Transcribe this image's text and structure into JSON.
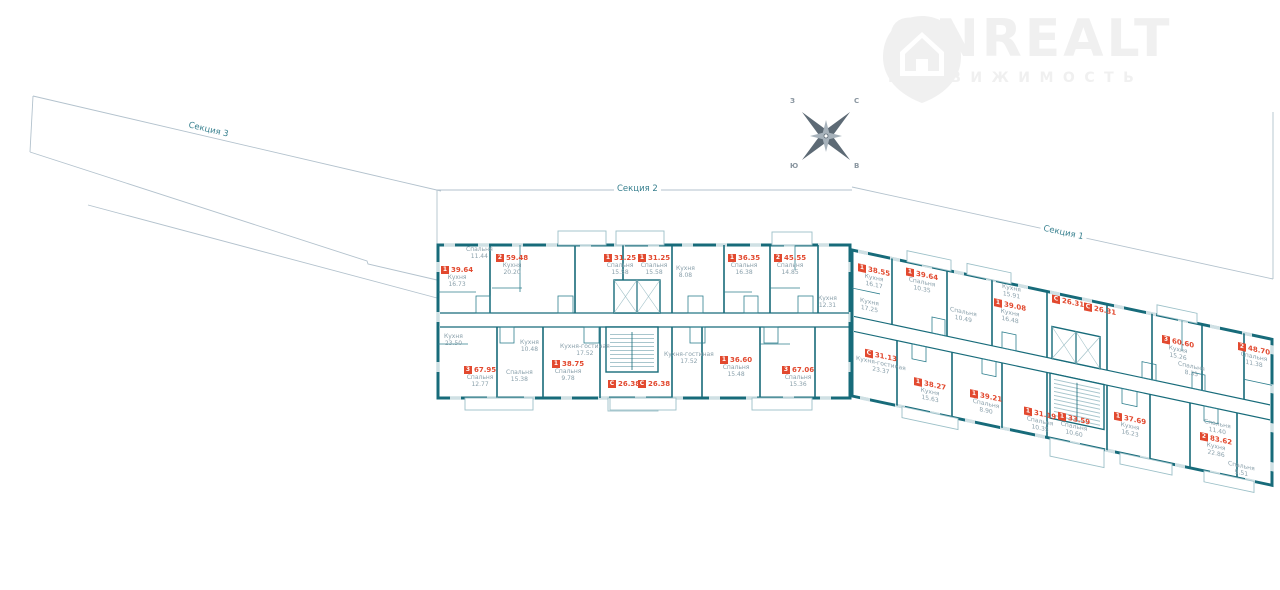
{
  "watermark": {
    "brand": "ONREALT",
    "subtitle": "НЕДВИЖИМОСТЬ"
  },
  "compass": {
    "north": "С",
    "east": "В",
    "south": "Ю",
    "west": "З"
  },
  "sections": {
    "s3": {
      "label": "Секция 3"
    },
    "s2": {
      "label": "Секция 2",
      "units": [
        {
          "rooms": "1",
          "area": "39.64",
          "room": "Кухня",
          "room_area": "16.73"
        },
        {
          "rooms": "2",
          "area": "59.48",
          "room": "Кухня",
          "room_area": "20.20"
        },
        {
          "rooms": "1",
          "area": "31.25",
          "room": "Спальня",
          "room_area": "15.58"
        },
        {
          "rooms": "1",
          "area": "31.25",
          "room": "Спальня",
          "room_area": "15.58"
        },
        {
          "rooms": "1",
          "area": "36.35",
          "room": "Спальня",
          "room_area": "16.38"
        },
        {
          "rooms": "2",
          "area": "45.55",
          "room": "Спальня",
          "room_area": "14.85"
        },
        {
          "rooms": "3",
          "area": "67.95",
          "room": "Спальня",
          "room_area": "12.77"
        },
        {
          "rooms": "1",
          "area": "38.75",
          "room": "Спальня",
          "room_area": "9.78"
        },
        {
          "rooms": "С",
          "area": "26.38",
          "room": "",
          "room_area": ""
        },
        {
          "rooms": "С",
          "area": "26.38",
          "room": "",
          "room_area": ""
        },
        {
          "rooms": "1",
          "area": "36.60",
          "room": "Спальня",
          "room_area": "15.48"
        },
        {
          "rooms": "3",
          "area": "67.06",
          "room": "Спальня",
          "room_area": "15.36"
        }
      ],
      "rooms": [
        {
          "name": "Спальня",
          "area": "11.44"
        },
        {
          "name": "Кухня",
          "area": "23.50"
        },
        {
          "name": "Спальня",
          "area": "15.38"
        },
        {
          "name": "Кухня",
          "area": "10.48"
        },
        {
          "name": "Кухня",
          "area": "8.08"
        },
        {
          "name": "Кухня-гостиная",
          "area": "17.52"
        },
        {
          "name": "Кухня-гостиная",
          "area": "17.52"
        },
        {
          "name": "Кухня",
          "area": "12.31"
        }
      ]
    },
    "s1": {
      "label": "Секция 1",
      "units": [
        {
          "rooms": "1",
          "area": "38.55",
          "room": "Кухня",
          "room_area": "16.17"
        },
        {
          "rooms": "1",
          "area": "39.64",
          "room": "Спальня",
          "room_area": "10.35"
        },
        {
          "rooms": "1",
          "area": "39.08",
          "room": "Кухня",
          "room_area": "16.48"
        },
        {
          "rooms": "С",
          "area": "26.31",
          "room": "",
          "room_area": ""
        },
        {
          "rooms": "С",
          "area": "26.31",
          "room": "",
          "room_area": ""
        },
        {
          "rooms": "3",
          "area": "60.60",
          "room": "Кухня",
          "room_area": "15.26"
        },
        {
          "rooms": "2",
          "area": "48.70",
          "room": "Спальня",
          "room_area": "11.38"
        },
        {
          "rooms": "С",
          "area": "31.13",
          "room": "Кухня-гостиная",
          "room_area": "23.37"
        },
        {
          "rooms": "1",
          "area": "38.27",
          "room": "Кухня",
          "room_area": "15.63"
        },
        {
          "rooms": "1",
          "area": "39.21",
          "room": "Спальня",
          "room_area": "8.90"
        },
        {
          "rooms": "1",
          "area": "31.19",
          "room": "Спальня",
          "room_area": "10.35"
        },
        {
          "rooms": "1",
          "area": "33.59",
          "room": "Спальня",
          "room_area": "10.60"
        },
        {
          "rooms": "1",
          "area": "37.69",
          "room": "Кухня",
          "room_area": "16.23"
        },
        {
          "rooms": "2",
          "area": "83.62",
          "room": "Кухня",
          "room_area": "22.86"
        }
      ],
      "rooms": [
        {
          "name": "Спальня",
          "area": "10.49"
        },
        {
          "name": "Кухня",
          "area": "17.25"
        },
        {
          "name": "Кухня",
          "area": "15.91"
        },
        {
          "name": "Спальня",
          "area": "11.40"
        },
        {
          "name": "Спальня",
          "area": "9.51"
        },
        {
          "name": "Спальня",
          "area": "8.35"
        }
      ]
    }
  },
  "colors": {
    "wall": "#176b7a",
    "thin_wall": "#2f7f8e",
    "accent": "#e2492f",
    "room_label": "#8aa0ab",
    "section_label": "#38808f",
    "outline": "#b3c2cd",
    "watermark": "#f0f0f0"
  }
}
